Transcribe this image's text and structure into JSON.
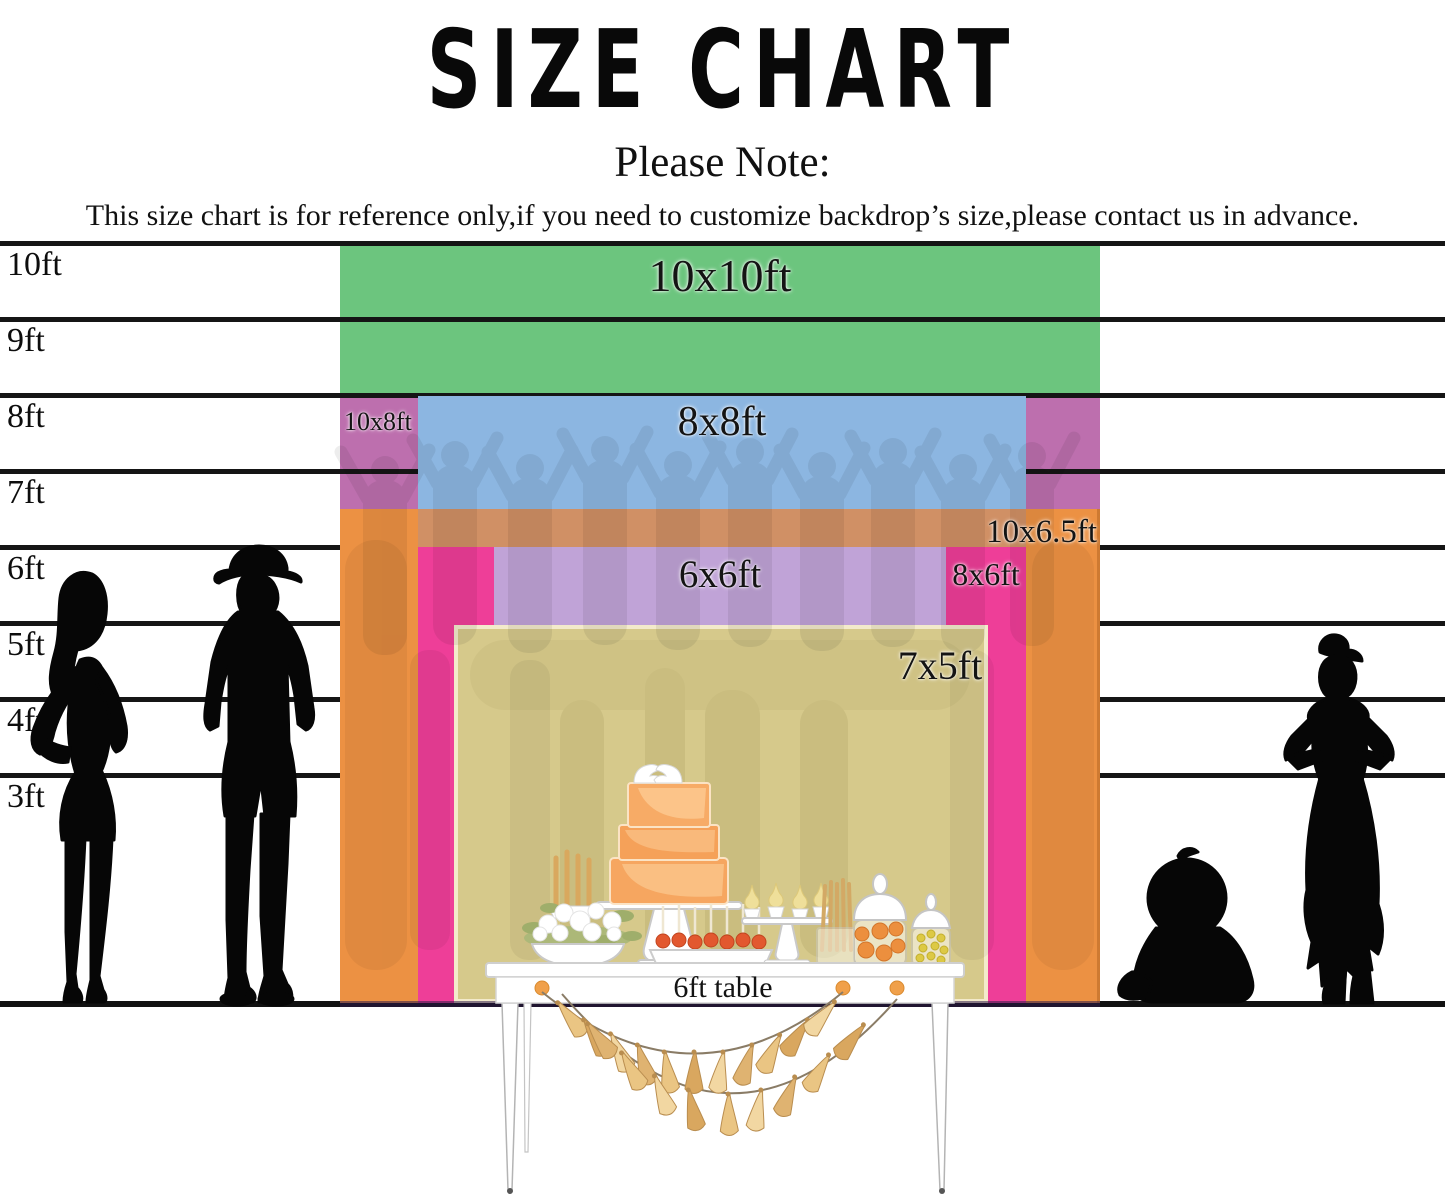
{
  "header": {
    "title": "SIZE CHART",
    "note_heading": "Please Note:",
    "disclaimer": "This size chart is for reference only,if you need to customize backdrop’s size,please contact us in advance."
  },
  "ruler": {
    "unit": "ft",
    "labels": [
      "10ft",
      "9ft",
      "8ft",
      "7ft",
      "6ft",
      "5ft",
      "4ft",
      "3ft"
    ]
  },
  "sizes": [
    {
      "label": "10x10ft",
      "width_ft": 10,
      "height_ft": 10,
      "color": "#6cc57e"
    },
    {
      "label": "10x8ft",
      "width_ft": 10,
      "height_ft": 8,
      "color": "#bd6fae"
    },
    {
      "label": "8x8ft",
      "width_ft": 8,
      "height_ft": 8,
      "color": "#8cb6e1"
    },
    {
      "label": "10x6.5ft",
      "width_ft": 10,
      "height_ft": 6.5,
      "color": "#ec9143"
    },
    {
      "label": "8x6ft",
      "width_ft": 8,
      "height_ft": 6,
      "color": "#ee3e98"
    },
    {
      "label": "6x6ft",
      "width_ft": 6,
      "height_ft": 6,
      "color": "#c0a3d7"
    },
    {
      "label": "7x5ft",
      "width_ft": 7,
      "height_ft": 5,
      "color": "#d6c98b"
    }
  ],
  "table": {
    "label": "6ft table"
  },
  "silhouettes": [
    "adult-woman",
    "adult-man-with-hat",
    "toddler-sitting",
    "girl-hands-on-hips"
  ],
  "decor": [
    "crowd-watermark",
    "tiered-cake",
    "dove-cake-topper",
    "tassel-garland",
    "candy-jars",
    "cupcake-stand",
    "flower-bowl",
    "candles",
    "cake-pops",
    "breadsticks"
  ]
}
